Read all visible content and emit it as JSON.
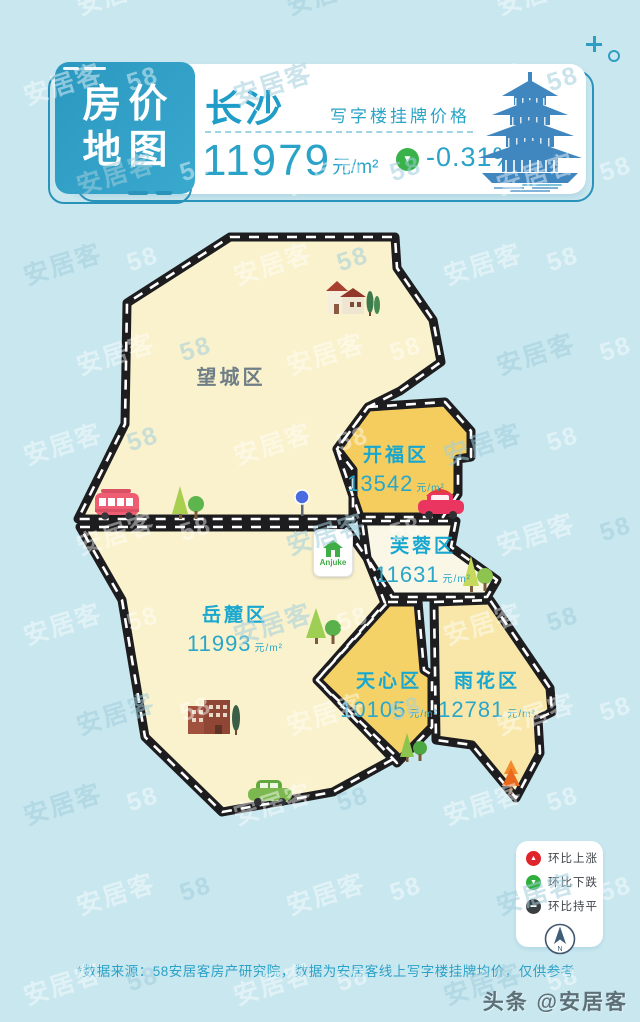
{
  "watermark": {
    "tokens": [
      "58",
      "安居客"
    ]
  },
  "overlay": {
    "toutiao": "头条 @安居客"
  },
  "header": {
    "badge": {
      "line1": "房价",
      "line2": "地图"
    },
    "city": "长沙",
    "subtitle": "写字楼挂牌价格",
    "price": "11979",
    "unit": "元/m²",
    "trend_icon": "▼",
    "change": "-0.31%"
  },
  "map": {
    "logo": "Anjuke",
    "districts": [
      {
        "name": "望城区",
        "price": "",
        "unit": "",
        "fill": "#faf2cc"
      },
      {
        "name": "开福区",
        "price": "13542",
        "unit": "元/m²",
        "fill": "#f5cd5e"
      },
      {
        "name": "芙蓉区",
        "price": "11631",
        "unit": "元/m²",
        "fill": "#fbf7e6"
      },
      {
        "name": "岳麓区",
        "price": "11993",
        "unit": "元/m²",
        "fill": "#faf2cc"
      },
      {
        "name": "天心区",
        "price": "10105",
        "unit": "元/m²",
        "fill": "#f5d267"
      },
      {
        "name": "雨花区",
        "price": "12781",
        "unit": "元/m²",
        "fill": "#f8e7a9"
      }
    ]
  },
  "legend": {
    "items": [
      {
        "label": "环比上涨",
        "icon": "▲",
        "color": "#e0242b"
      },
      {
        "label": "环比下跌",
        "icon": "▼",
        "color": "#2eaf3c"
      },
      {
        "label": "环比持平",
        "icon": "▬",
        "color": "#3a3f42"
      }
    ],
    "compass": "N"
  },
  "footer": {
    "note": "*数据来源：58安居客房产研究院，数据为安居客线上写字楼挂牌均价，仅供参考"
  },
  "colors": {
    "background": "#c9e7ef",
    "accent_teal": "#2aa3c8",
    "badge_teal": "#2b98c0",
    "gold": "#f5cd5e",
    "pale_yellow": "#faf2cc",
    "cream": "#fbf7e6",
    "light_gold": "#f8e7a9",
    "road_black": "#1d1d1f",
    "up_red": "#e0242b",
    "down_green": "#2eaf3c",
    "flat_dark": "#3a3f42"
  }
}
